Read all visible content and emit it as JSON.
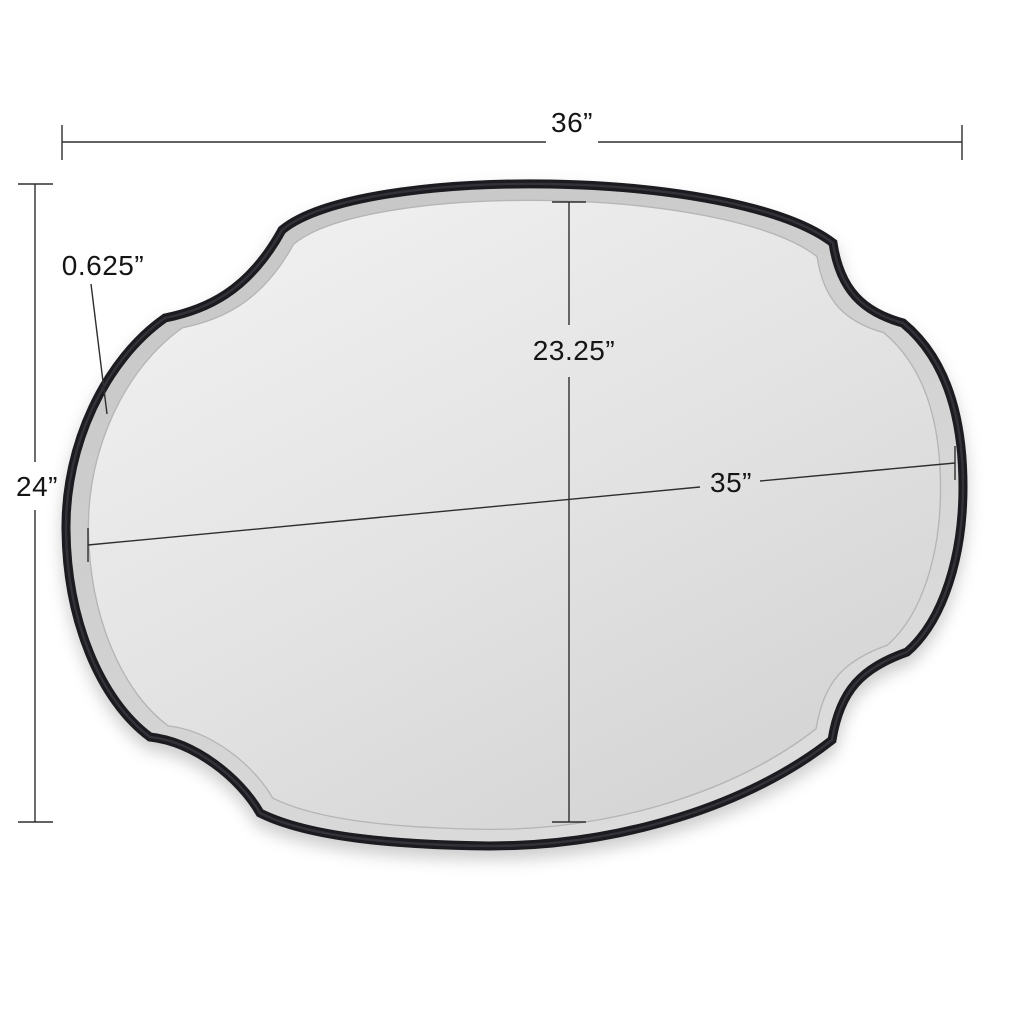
{
  "diagram": {
    "kind": "product-dimension-diagram",
    "product": "scalloped-oval-wall-mirror"
  },
  "labels": {
    "overall_width": "36”",
    "overall_height": "24”",
    "frame_thickness": "0.625”",
    "mirror_height": "23.25”",
    "mirror_width": "35”"
  },
  "colors": {
    "background": "#ffffff",
    "frame": "#1b1b20",
    "frame_highlight": "#45454f",
    "glass_light": "#f1f1f1",
    "glass_mid": "#e3e3e3",
    "glass_dark": "#d2d2d2",
    "band_light": "#dedede",
    "band_dark": "#c6c6c6",
    "bevel_line": "#b5b5b5",
    "dimension_line": "#2e2e2e"
  }
}
